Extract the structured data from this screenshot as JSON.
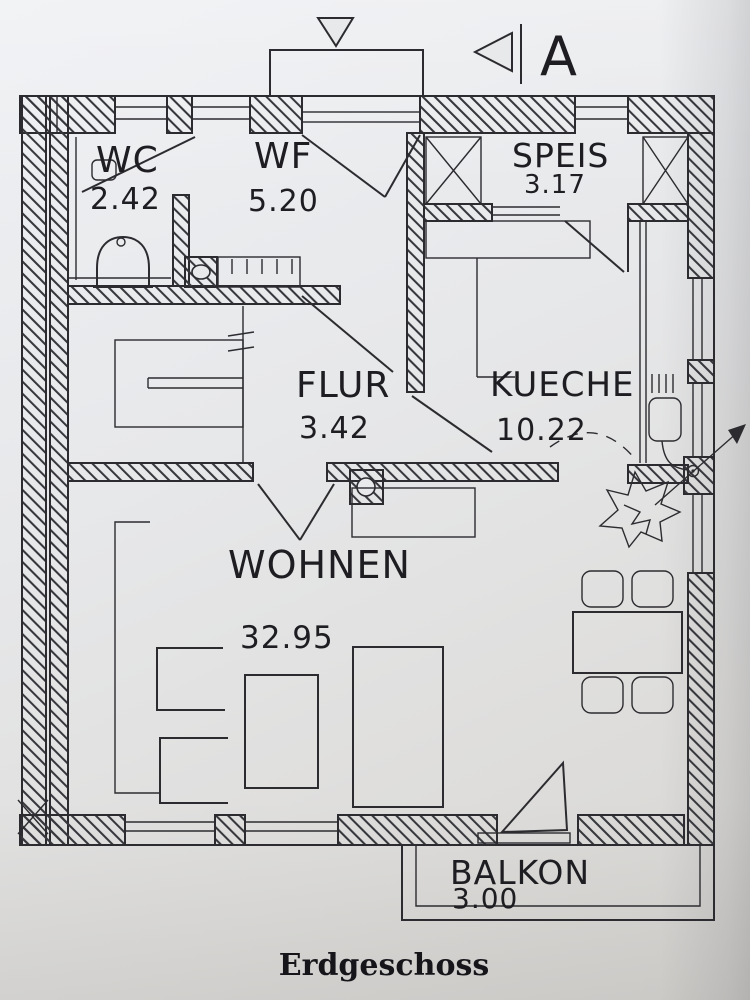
{
  "plan": {
    "title": "Erdgeschoss",
    "section_marker": "A",
    "rooms": {
      "wc": {
        "name": "WC",
        "area": "2.42"
      },
      "wf": {
        "name": "WF",
        "area": "5.20"
      },
      "speis": {
        "name": "SPEIS",
        "area": "3.17"
      },
      "flur": {
        "name": "FLUR",
        "area": "3.42"
      },
      "kueche": {
        "name": "KUECHE",
        "area": "10.22"
      },
      "wohnen": {
        "name": "WOHNEN",
        "area": "32.95"
      },
      "balkon": {
        "name": "BALKON",
        "area": "3.00"
      }
    },
    "colors": {
      "ink": "#2c2c30",
      "paper_light": "#eef0f3",
      "paper_dark": "#d5d4d1"
    }
  }
}
